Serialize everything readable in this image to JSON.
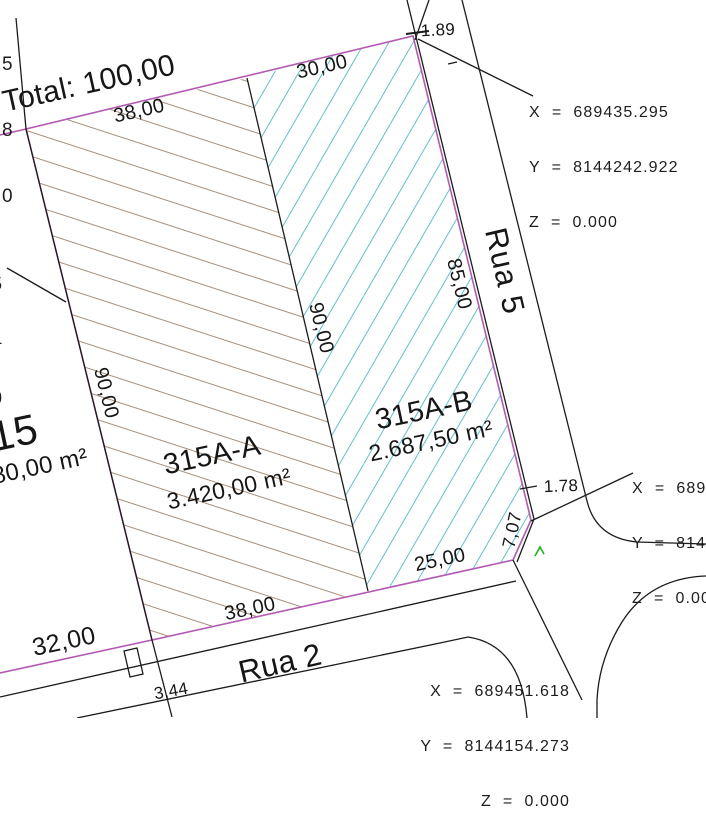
{
  "labels": {
    "total": "Total: 100,00",
    "street_right": "Rua 5",
    "street_bottom": "Rua 2"
  },
  "lots": {
    "a": {
      "name": "315A-A",
      "area": "3.420,00 m²"
    },
    "b": {
      "name": "315A-B",
      "area": "2.687,50 m²"
    },
    "neighbor": {
      "name_partial": "15",
      "area_partial": "80,00 m²"
    }
  },
  "dims": {
    "top_a": "38,00",
    "top_b": "30,00",
    "left": "90,00",
    "divider": "90,00",
    "right": "85,00",
    "bottom_a": "38,00",
    "bottom_b": "25,00",
    "west": "32,00",
    "chamfer": "7,07",
    "small_corner": "3,44",
    "offset_top": "1.89",
    "offset_right": "1.78",
    "tiny_dash": "-"
  },
  "coord_blocks": {
    "top": {
      "x": "X  =  689435.295",
      "y": "Y  =  8144242.922",
      "z": "Z  =  0.000"
    },
    "bottom": {
      "x": "X  =  689451.618",
      "y": "Y  =  8144154.273",
      "z": "Z  =  0.000"
    },
    "right": {
      "x": "X  =  689",
      "y": "Y  =  814",
      "z": "Z  =  0.00"
    }
  },
  "fragments": {
    "top_left": {
      "l1": "5",
      "l2": "8",
      "l3": "0"
    },
    "mid_left": {
      "l1": "5",
      "l2": "4",
      "l3": "0"
    }
  },
  "colors": {
    "boundary": "#b25ab2",
    "lines": "#1b1b1b",
    "hatch_a": "#a8907a",
    "hatch_b": "#63bfd0",
    "marker": "#1ab21a"
  }
}
